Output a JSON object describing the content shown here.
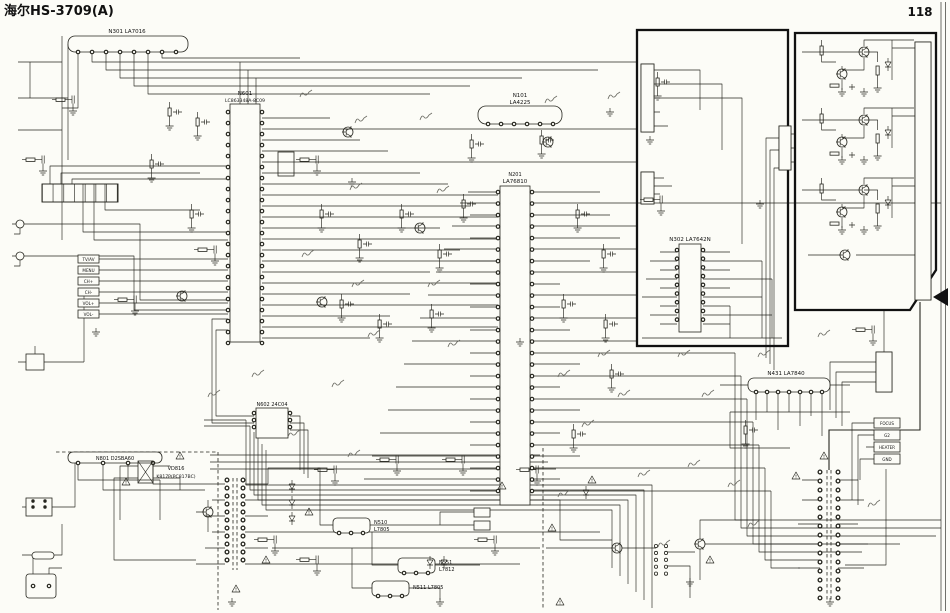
{
  "header": {
    "title": "海尔HS-3709(A)",
    "page_number": "118"
  },
  "ics": {
    "n301": {
      "label": "N301 LA7016"
    },
    "n601": {
      "designator": "N601",
      "part": "LC863348A-8C09"
    },
    "n602": {
      "label": "N602 24C04"
    },
    "n101": {
      "designator": "N101",
      "part": "LA4225"
    },
    "n201": {
      "designator": "N201",
      "part": "LA76810"
    },
    "n302": {
      "label": "N302 LA7642N"
    },
    "n431": {
      "label": "N431 LA7840"
    },
    "n801": {
      "label": "N801 D2SBA60"
    },
    "vd816": {
      "designator": "VD816",
      "part": "K817P(PC817BC)"
    },
    "n510": {
      "designator": "N510",
      "part": "L7805"
    },
    "n551": {
      "designator": "N551",
      "part": "L7812"
    },
    "n511": {
      "label": "N511 L7805"
    }
  },
  "front_keys": {
    "items": [
      {
        "label": "TV/AV"
      },
      {
        "label": "MENU"
      },
      {
        "label": "CH+"
      },
      {
        "label": "CH-"
      },
      {
        "label": "VOL+"
      },
      {
        "label": "VOL-"
      }
    ]
  },
  "crt_socket": {
    "labels": [
      {
        "text": "FOCUS"
      },
      {
        "text": "G2"
      },
      {
        "text": "HEATER"
      },
      {
        "text": "GND"
      }
    ]
  }
}
